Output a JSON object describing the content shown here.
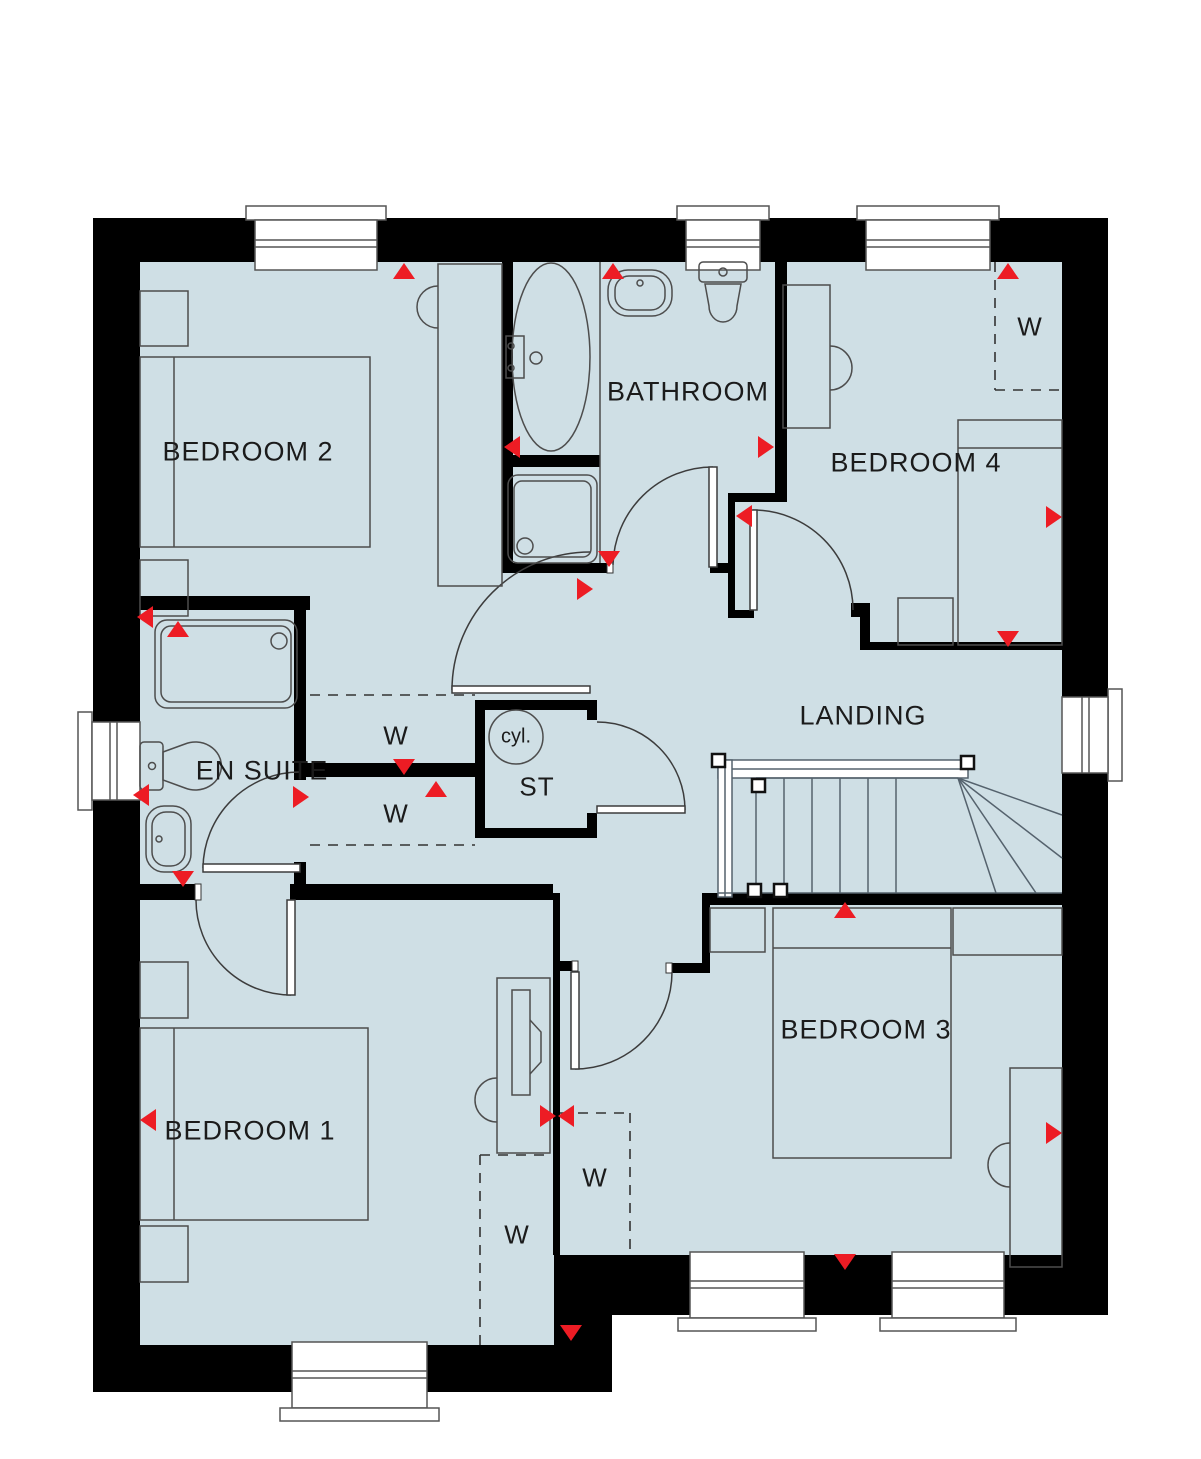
{
  "plan": {
    "type": "first-floor house floorplan",
    "colors": {
      "floor": "#cfdfe5",
      "wall": "#000000",
      "arrow_red": "#ed1c24",
      "furniture_line": "#4d4d4d",
      "stairs_line": "#55626d"
    },
    "labels": {
      "bedroom2": "BEDROOM 2",
      "bathroom": "BATHROOM",
      "bedroom4": "BEDROOM 4",
      "ensuite": "EN SUITE",
      "landing": "LANDING",
      "bedroom1": "BEDROOM 1",
      "bedroom3": "BEDROOM 3",
      "storage": "ST",
      "cylinder": "cyl.",
      "wardrobe": "W"
    }
  }
}
